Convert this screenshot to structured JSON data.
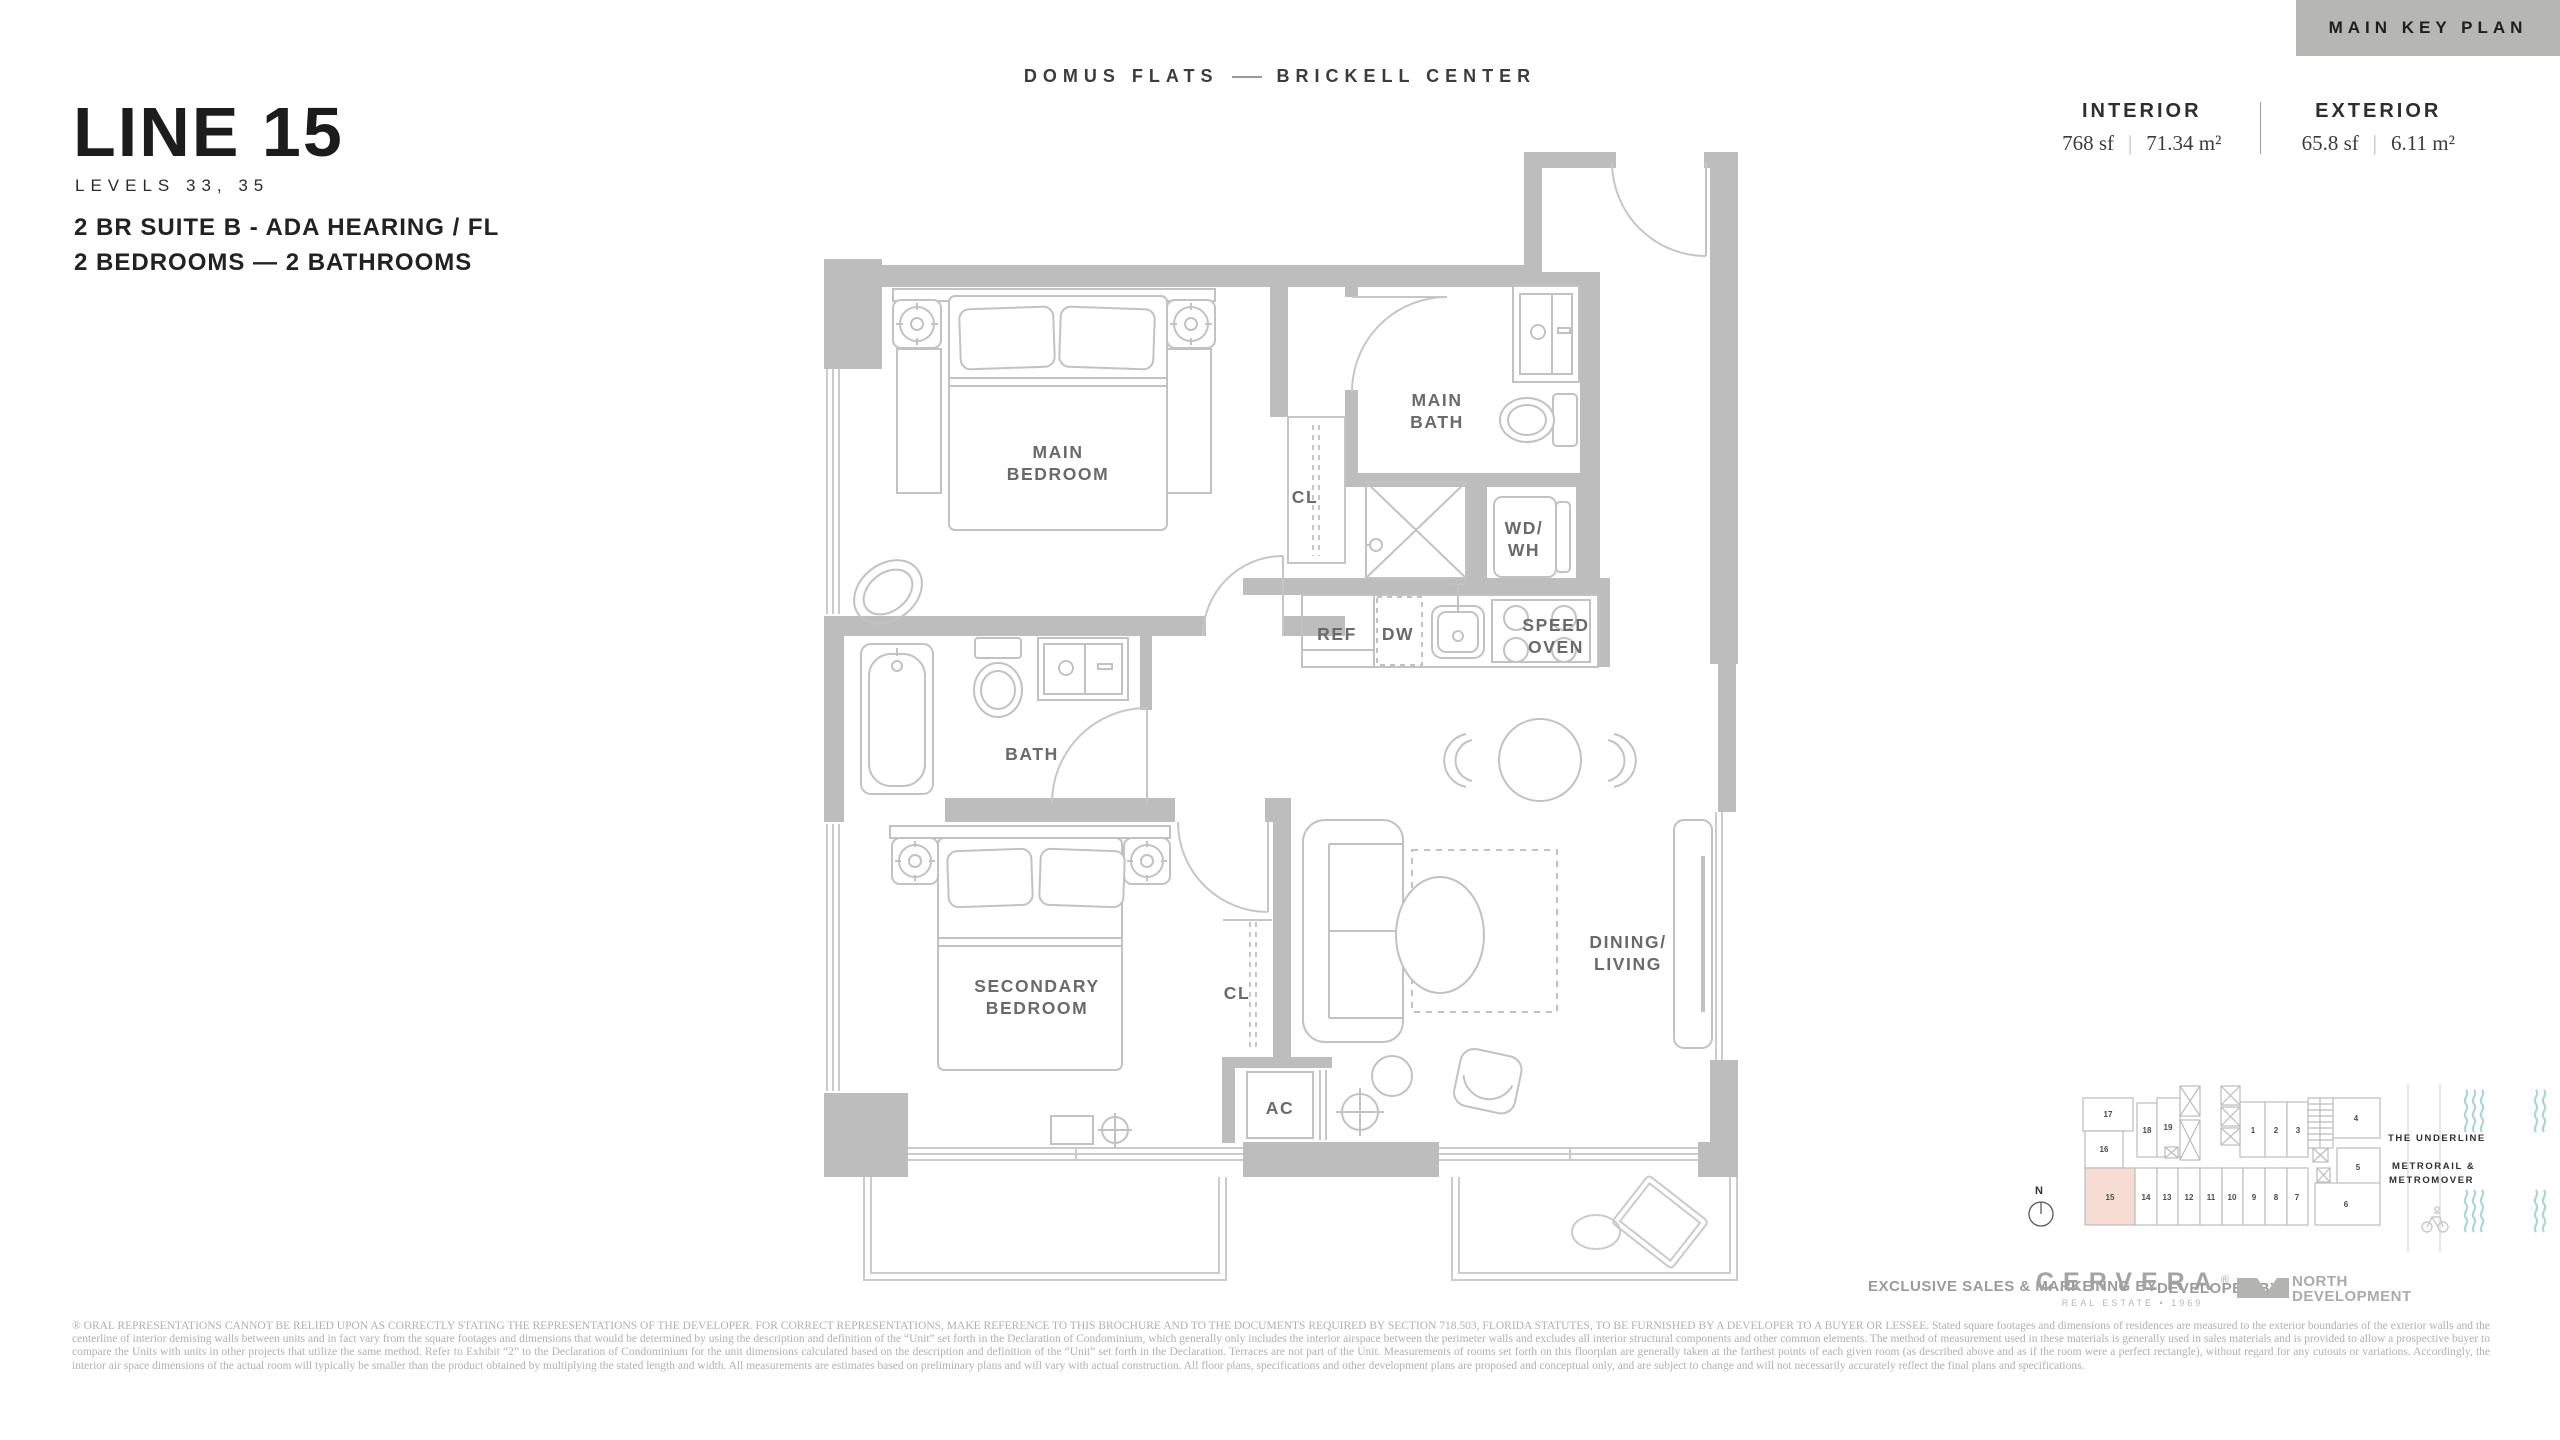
{
  "key_plan_tab": "MAIN KEY PLAN",
  "brand": {
    "left": "DOMUS FLATS",
    "right": "BRICKELL CENTER"
  },
  "unit": {
    "name": "LINE 15",
    "levels": "LEVELS 33, 35",
    "suite": "2 BR SUITE B - ADA HEARING / FL",
    "rooms": "2 BEDROOMS — 2 BATHROOMS"
  },
  "stats": {
    "interior_label": "INTERIOR",
    "interior_sf": "768 sf",
    "interior_m2": "71.34 m²",
    "exterior_label": "EXTERIOR",
    "exterior_sf": "65.8 sf",
    "exterior_m2": "6.11 m²",
    "separator": "|"
  },
  "plan_labels": {
    "main_bedroom_1": "MAIN",
    "main_bedroom_2": "BEDROOM",
    "main_bath_1": "MAIN",
    "main_bath_2": "BATH",
    "cl_main": "CL",
    "wd_wh_1": "WD/",
    "wd_wh_2": "WH",
    "ref": "REF",
    "dw": "DW",
    "speed_oven_1": "SPEED",
    "speed_oven_2": "OVEN",
    "bath": "BATH",
    "secondary_bedroom_1": "SECONDARY",
    "secondary_bedroom_2": "BEDROOM",
    "cl_secondary": "CL",
    "ac": "AC",
    "dining_living_1": "DINING/",
    "dining_living_2": "LIVING"
  },
  "keyplan": {
    "u1": "1",
    "u2": "2",
    "u3": "3",
    "u4": "4",
    "u5": "5",
    "u6": "6",
    "u7": "7",
    "u8": "8",
    "u9": "9",
    "u10": "10",
    "u11": "11",
    "u12": "12",
    "u13": "13",
    "u14": "14",
    "u15": "15",
    "u16": "16",
    "u17": "17",
    "u18": "18",
    "u19": "19",
    "north": "N",
    "underline": "THE UNDERLINE",
    "metro_line1": "METRORAIL &",
    "metro_line2": "METROMOVER",
    "highlighted_unit": "15"
  },
  "footer": {
    "sales_prefix": "EXCLUSIVE SALES & MARKETING BY",
    "cervera": "CERVERA",
    "cervera_reg": "®",
    "cervera_sub": "REAL ESTATE • 1969",
    "developed_prefix": "DEVELOPED BY",
    "developer_line1": "NORTH",
    "developer_line2": "DEVELOPMENT"
  },
  "disclaimer": "® ORAL REPRESENTATIONS CANNOT BE RELIED UPON AS CORRECTLY STATING THE REPRESENTATIONS OF THE DEVELOPER. FOR CORRECT REPRESENTATIONS, MAKE REFERENCE TO THIS BROCHURE AND TO THE DOCUMENTS REQUIRED BY SECTION 718.503, FLORIDA STATUTES, TO BE FURNISHED BY A DEVELOPER TO A BUYER OR LESSEE. Stated square footages and dimensions of residences are measured to the exterior boundaries of the exterior walls and the centerline of interior demising walls between units and in fact vary from the square footages and dimensions that would be determined by using the description and definition of the “Unit” set forth in the Declaration of Condominium, which generally only includes the interior airspace between the perimeter walls and excludes all interior structural components and other common elements.  The method of measurement used in these materials is generally used in sales materials and is provided to allow a prospective buyer to compare the Units with units in other projects that utilize the same method. Refer to Exhibit “2” to the Declaration of Condominium for the unit dimensions calculated based on the description and definition of the “Unit” set forth in the Declaration. Terraces are not part of the Unit.  Measurements of rooms set forth on this floorplan are generally taken at the farthest points of each given room (as described above and as if the room were a perfect rectangle), without regard for any cutouts or variations.  Accordingly, the interior air space dimensions of the actual room will typically be smaller than the product obtained by multiplying the stated length and width.  All measurements are estimates based on preliminary plans and will vary with actual construction. All floor plans, specifications and other development plans are proposed and conceptual only, and are subject to change and will not necessarily accurately reflect the final plans and specifications.",
  "colors": {
    "wall_gray": "#bdbdbd",
    "tab_gray": "#b6b6b4",
    "keyplan_highlight": "#f6dcd2",
    "teal_accent": "#abd8d1",
    "label_gray": "#6a6a6a"
  }
}
